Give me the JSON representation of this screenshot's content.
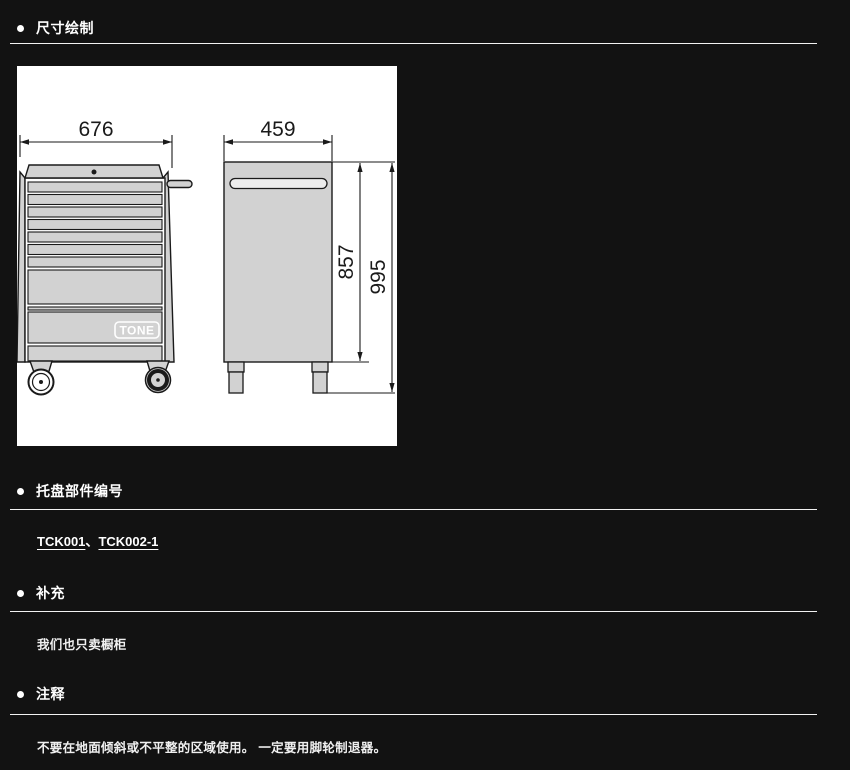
{
  "sections": {
    "dimension": {
      "title": "尺寸绘制"
    },
    "tray": {
      "title": "托盘部件编号",
      "link1": "TCK001",
      "separator": "、",
      "link2": "TCK002-1"
    },
    "supplement": {
      "title": "补充",
      "body": "我们也只卖橱柜"
    },
    "notes": {
      "title": "注释",
      "body": "不要在地面倾斜或不平整的区域使用。 一定要用脚轮制退器。"
    }
  },
  "drawing": {
    "front_width_mm": "676",
    "depth_mm": "459",
    "body_height_mm": "857",
    "total_height_mm": "995",
    "logo_text": "TONE"
  },
  "colors": {
    "background": "#121212",
    "divider": "#f2f2f2",
    "drawing_fill": "#d2d2d2",
    "drawing_stroke": "#1a1a1a"
  }
}
